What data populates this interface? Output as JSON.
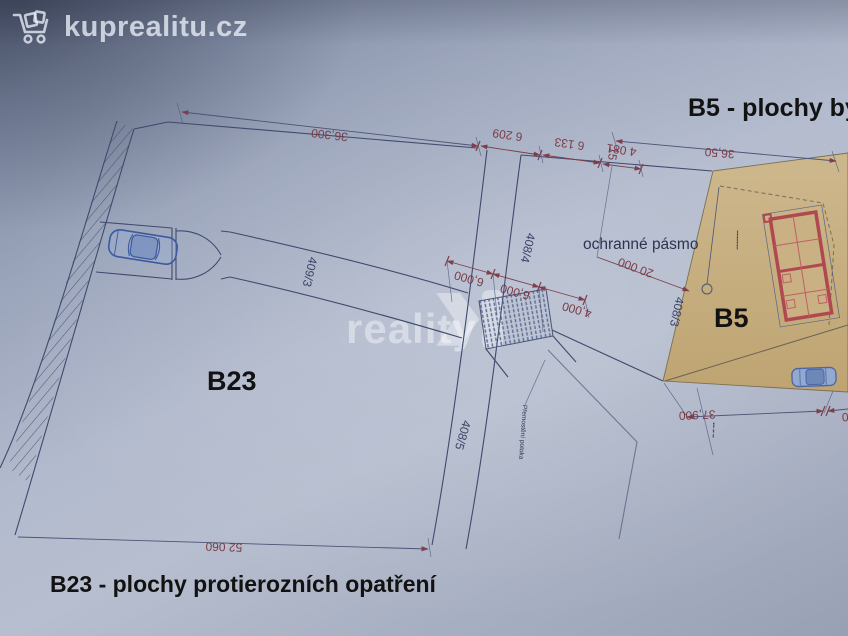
{
  "brand": {
    "logo_text": "kuprealitu.cz"
  },
  "watermark": {
    "text": "reality"
  },
  "headings": {
    "b5_title": "B5 - plochy by",
    "b23_title": "B23 - plochy protierozních opatření"
  },
  "zone_labels": {
    "b5": "B5",
    "b23": "B23"
  },
  "parcel_labels": {
    "p409_3": "409/3",
    "p408_4": "408/4",
    "p408_5": "408/5",
    "p408_3": "408/3"
  },
  "annotations": {
    "ochranne_pasmo": "ochranné pásmo",
    "bridge_note": "Přemostění potoka",
    "b5_tiny_note": "▪▪▪▪▪▪▪▪▪▪▪▪",
    "right_tiny_note": "▪▪▪ ▪▪ ▪▪",
    "tick_15": "15"
  },
  "dimensions": {
    "top_main": "36,300",
    "top_seg1": "6 209",
    "top_seg2": "6 133",
    "top_seg3": "4 081",
    "top_right": "36,50",
    "protection": "20 000",
    "mid_1": "6,000",
    "mid_2": "6,000",
    "mid_3": "4,000",
    "bottom": "52 060",
    "bottom_right": "37,900",
    "bottom_right_partial": "0"
  },
  "colors": {
    "paper": "#a9b2c6",
    "parcel_fill": "#c7ae7e",
    "dimension": "#7a3c47",
    "line": "#3f4a6e",
    "building": "#b0494f",
    "parcel_label": "#3c4468"
  }
}
